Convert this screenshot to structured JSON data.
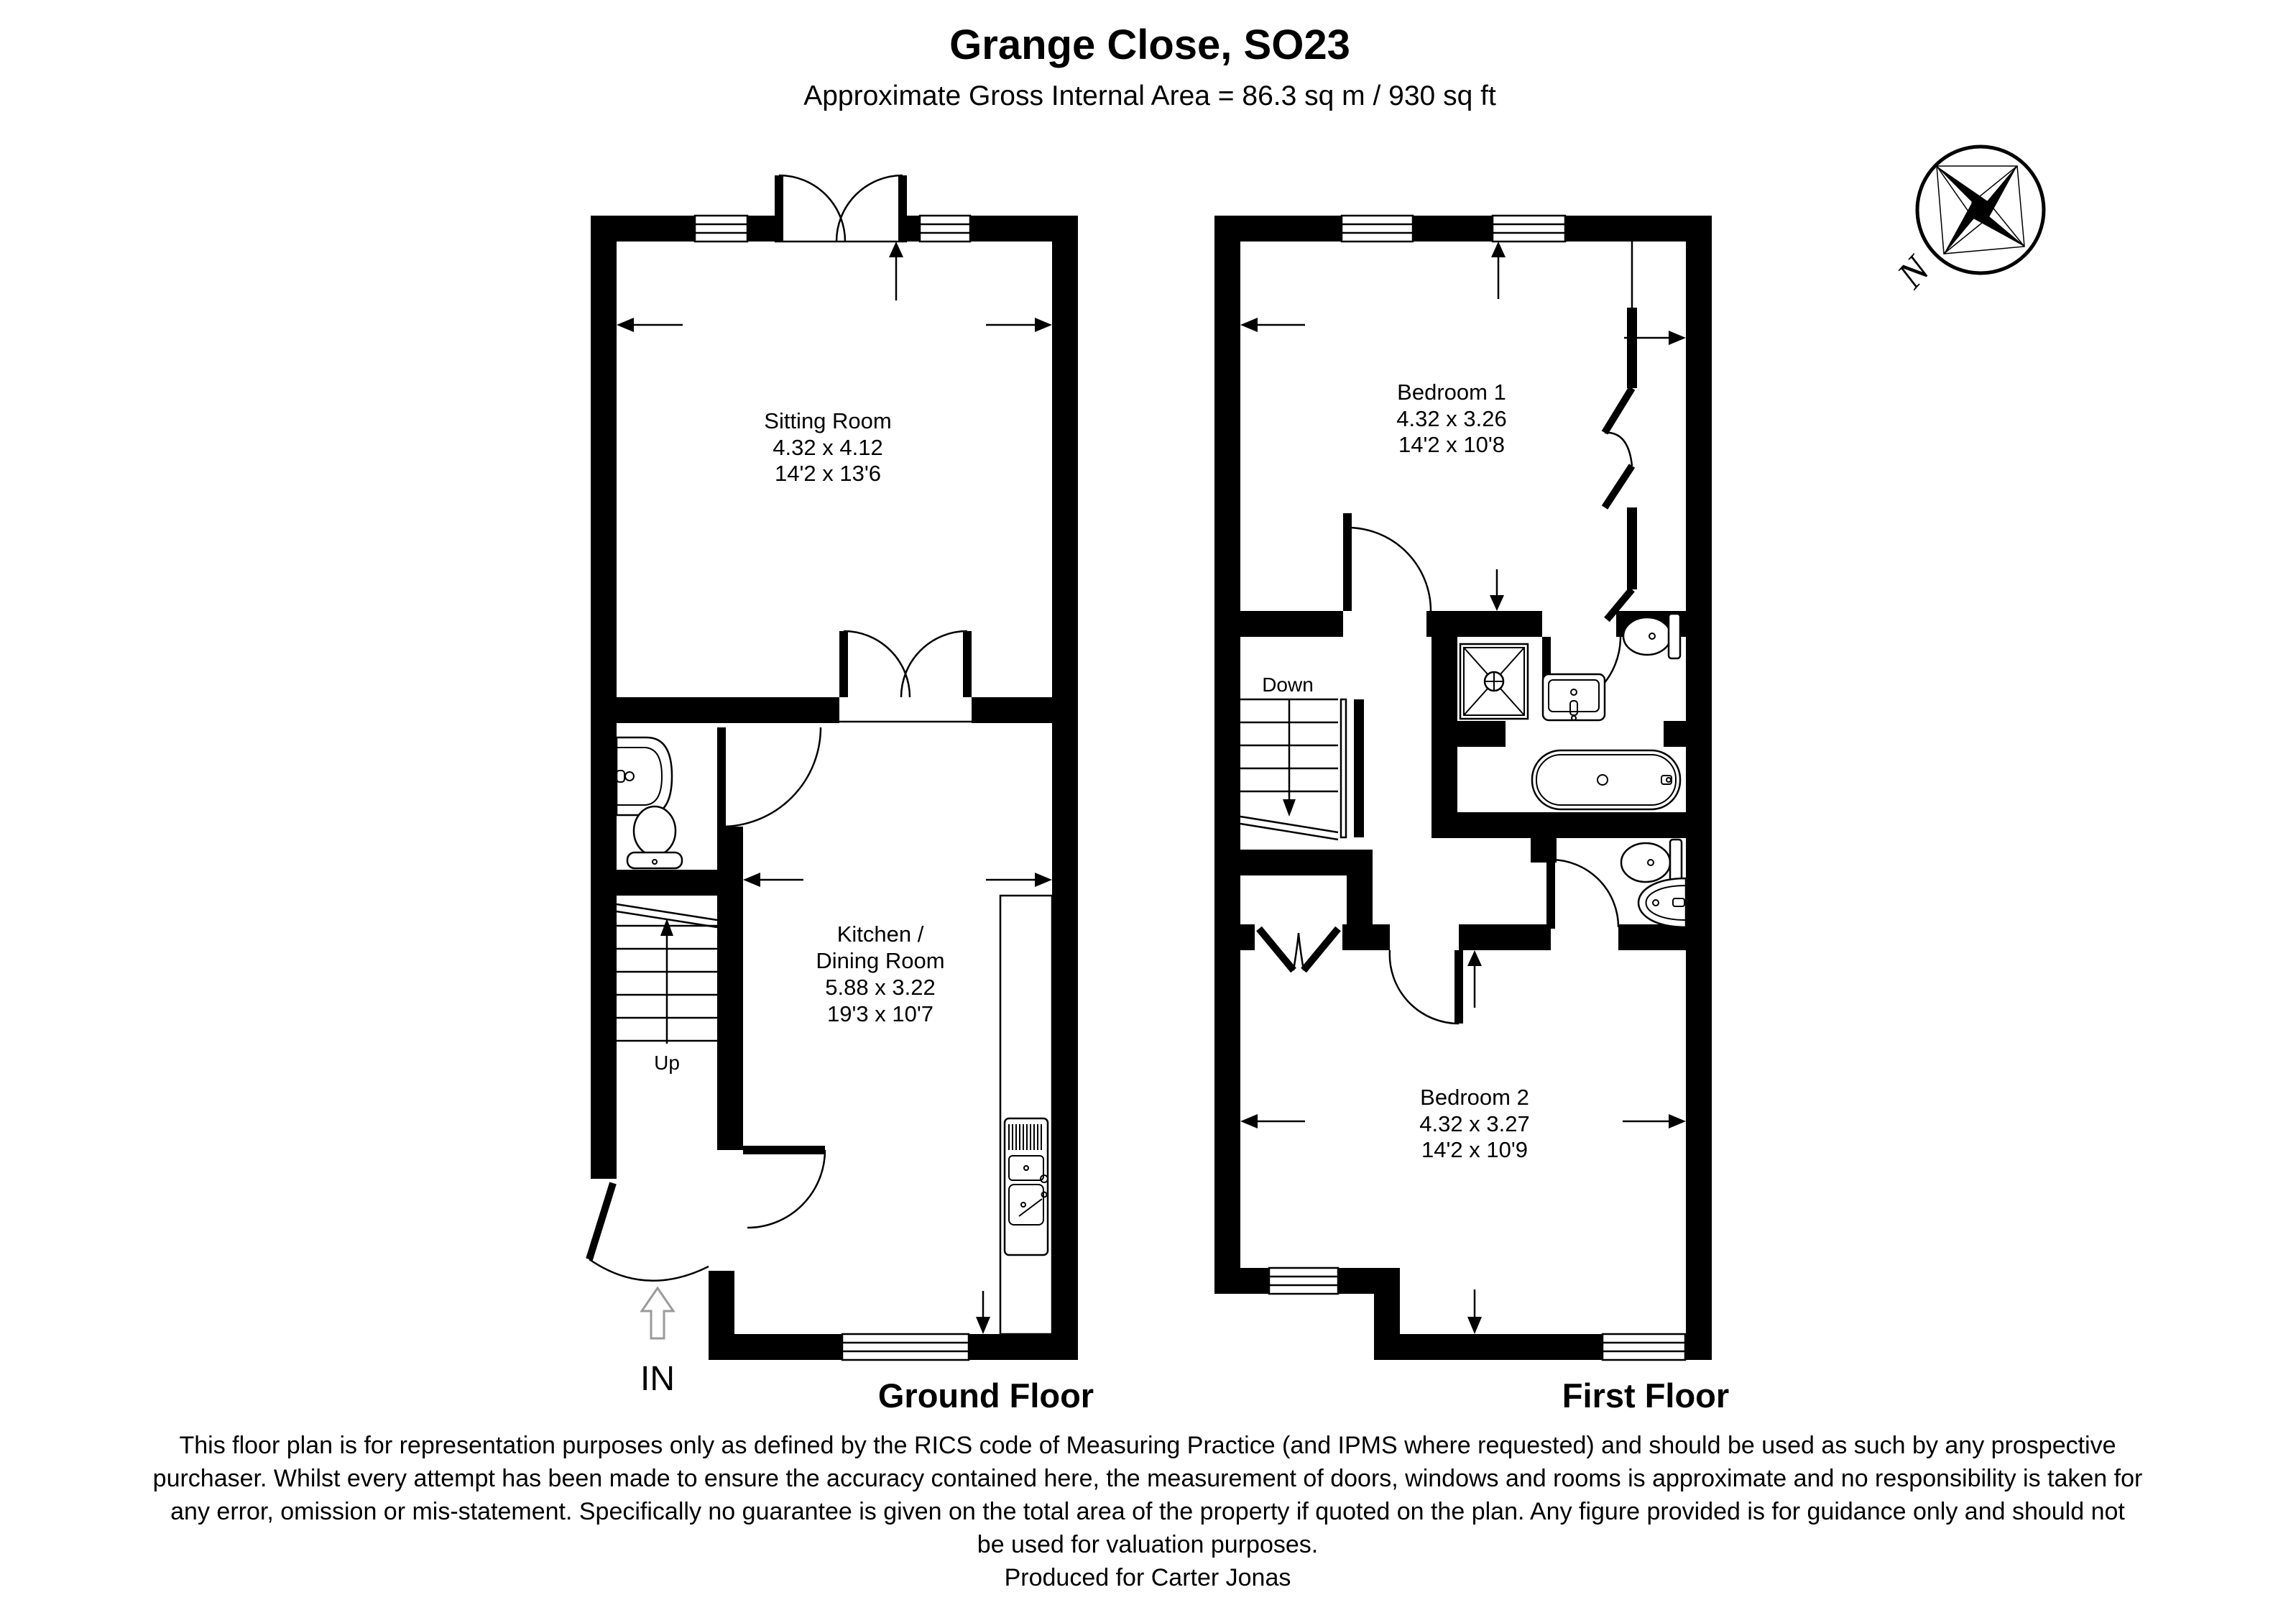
{
  "header": {
    "title": "Grange Close, SO23",
    "subtitle": "Approximate Gross Internal Area = 86.3 sq m / 930 sq ft"
  },
  "compass": {
    "north_label": "N"
  },
  "ground_floor": {
    "label": "Ground Floor",
    "sitting_room": {
      "name": "Sitting Room",
      "metric": "4.32 x 4.12",
      "imperial": "14'2 x 13'6"
    },
    "kitchen": {
      "name_line1": "Kitchen /",
      "name_line2": "Dining Room",
      "metric": "5.88 x 3.22",
      "imperial": "19'3 x 10'7"
    },
    "stairs_label": "Up",
    "entrance_label": "IN"
  },
  "first_floor": {
    "label": "First Floor",
    "bedroom1": {
      "name": "Bedroom 1",
      "metric": "4.32 x 3.26",
      "imperial": "14'2 x 10'8"
    },
    "bedroom2": {
      "name": "Bedroom 2",
      "metric": "4.32 x 3.27",
      "imperial": "14'2 x 10'9"
    },
    "stairs_label": "Down"
  },
  "disclaimer": {
    "lines": [
      "This floor plan is for representation purposes only as defined by the RICS code of Measuring Practice (and IPMS where requested) and should be used as such by any prospective",
      "purchaser. Whilst every attempt has been made to ensure the accuracy contained here, the measurement of doors, windows and rooms is approximate and no responsibility is taken for",
      "any error, omission or mis-statement. Specifically no guarantee is given on the total area of the property if quoted on the plan. Any figure provided is for guidance only and should not",
      "be used for valuation purposes."
    ],
    "credit": "Produced for Carter Jonas"
  }
}
